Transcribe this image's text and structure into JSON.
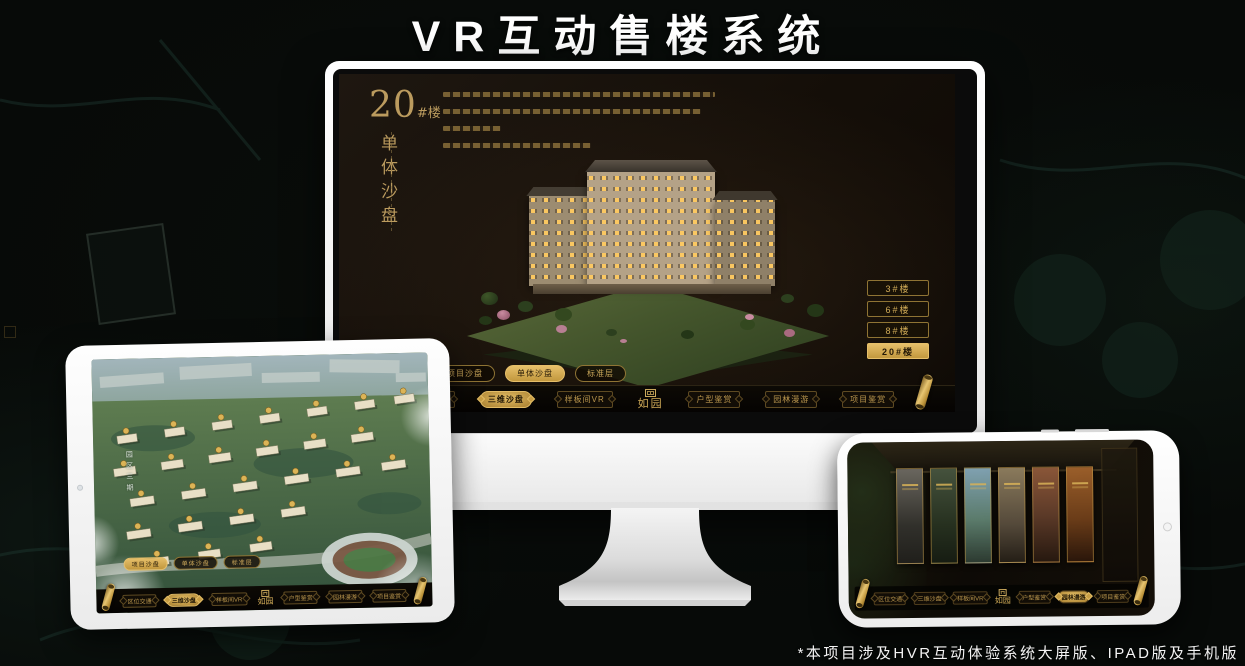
{
  "title": "VR互动售楼系统",
  "footnote": "*本项目涉及HVR互动体验系统大屏版、IPAD版及手机版",
  "brand": {
    "logo": "如园"
  },
  "colors": {
    "accent_gold": "#d2ac58",
    "active_gold": "#e2bc66",
    "screen_bg": "#140e08",
    "device_white": "#ffffff"
  },
  "monitor": {
    "unit": {
      "number": "20",
      "suffix": "#楼",
      "subtitle": "单体沙盘"
    },
    "floor_buttons": [
      {
        "label": "3#楼",
        "active": false
      },
      {
        "label": "6#楼",
        "active": false
      },
      {
        "label": "8#楼",
        "active": false
      },
      {
        "label": "20#楼",
        "active": true
      }
    ],
    "mode_tabs": [
      {
        "label": "项目沙盘",
        "active": false
      },
      {
        "label": "单体沙盘",
        "active": true
      },
      {
        "label": "标准层",
        "active": false
      }
    ],
    "nav": {
      "items": [
        {
          "label": "区位交通",
          "active": false
        },
        {
          "label": "三维沙盘",
          "active": true
        },
        {
          "label": "样板间VR",
          "active": false
        },
        {
          "label": "户型鉴赏",
          "active": false
        },
        {
          "label": "园林漫游",
          "active": false
        },
        {
          "label": "项目鉴赏",
          "active": false
        }
      ],
      "logo": "如园"
    }
  },
  "tablet": {
    "road_label": "园区三期",
    "mode_tabs": [
      {
        "label": "项目沙盘",
        "active": true
      },
      {
        "label": "单体沙盘",
        "active": false
      },
      {
        "label": "标准层",
        "active": false
      }
    ],
    "nav": {
      "items": [
        {
          "label": "区位交通",
          "active": false
        },
        {
          "label": "三维沙盘",
          "active": true
        },
        {
          "label": "样板间VR",
          "active": false
        },
        {
          "label": "户型鉴赏",
          "active": false
        },
        {
          "label": "园林漫游",
          "active": false
        },
        {
          "label": "项目鉴赏",
          "active": false
        }
      ],
      "logo": "如园"
    }
  },
  "phone": {
    "nav": {
      "items": [
        {
          "label": "区位交通",
          "active": false
        },
        {
          "label": "三维沙盘",
          "active": false
        },
        {
          "label": "样板间VR",
          "active": false
        },
        {
          "label": "户型鉴赏",
          "active": false
        },
        {
          "label": "园林漫游",
          "active": true
        },
        {
          "label": "项目鉴赏",
          "active": false
        }
      ],
      "logo": "如园"
    }
  }
}
